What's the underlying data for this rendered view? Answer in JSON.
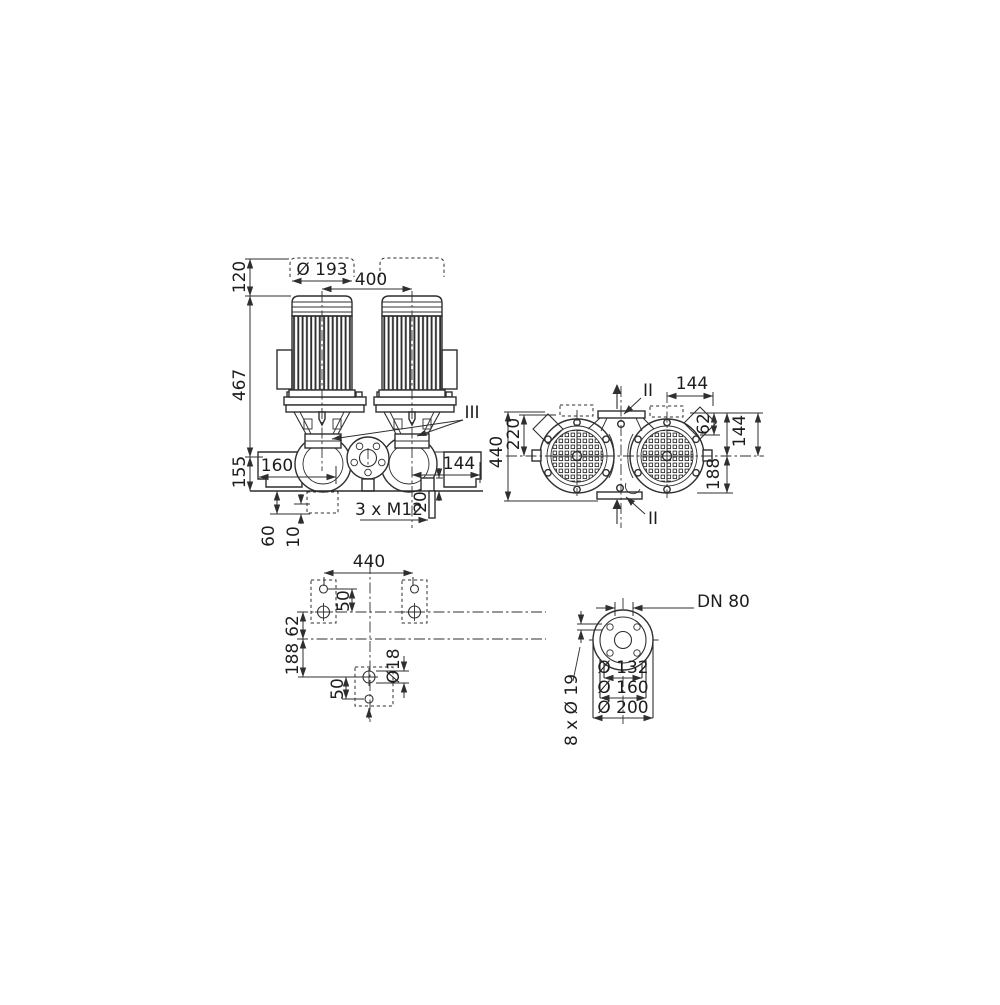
{
  "drawing": {
    "kind": "dimensional technical drawing",
    "subject": "twin-head inline centrifugal pump"
  },
  "colors": {
    "line": "#2f2f2f",
    "ink": "#1d1d1d",
    "background": "#ffffff"
  },
  "front_view": {
    "dims": {
      "motor_diameter": "Ø 193",
      "motor_spacing": "400",
      "height_above_motor": "120",
      "height_total": "467",
      "base_to_axis": "155",
      "offset_left": "160",
      "offset_right": "144",
      "drain_offset": "20",
      "drain_plug_thread": "3 x M12",
      "foundation_depth": "60",
      "grout_thickness": "10",
      "detail_ref": "III"
    }
  },
  "plan_view": {
    "dims": {
      "overall_depth": "440",
      "half_depth": "220",
      "terminal_box_offset": "144",
      "edge_62": "62",
      "edge_144": "144",
      "edge_188": "188"
    },
    "section": {
      "top": "II",
      "bottom": "II"
    }
  },
  "foundation_view": {
    "dims": {
      "bolt_spacing": "440",
      "upper_hole_pitch": "50",
      "offset_62": "62",
      "offset_188": "188",
      "lower_hole_pitch": "50",
      "hole_diameter": "Ø18"
    }
  },
  "flange_view": {
    "dims": {
      "nominal_diameter": "DN 80",
      "bolt_circle": "Ø 132",
      "raised_face": "Ø 160",
      "outer_diameter": "Ø 200",
      "bolt_holes": "8 x Ø 19"
    }
  }
}
